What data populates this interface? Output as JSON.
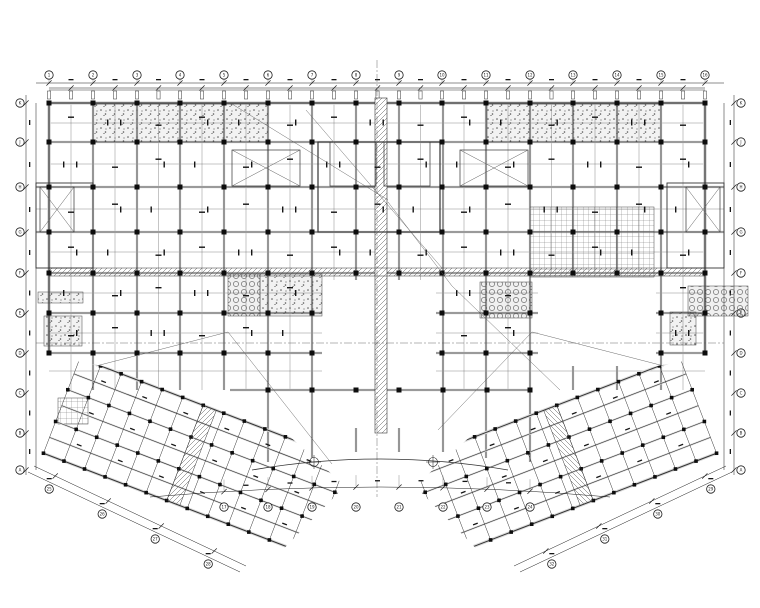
{
  "page": {
    "width": 760,
    "height": 608,
    "background": "#ffffff"
  },
  "colors": {
    "ink": "#1b1b1b",
    "beam_core": "#333333",
    "beam_halo": "#d8d8d8",
    "minor": "#5a5a5a",
    "column": "#0d0d0d",
    "hatch": "#555555",
    "speck": "#151515",
    "white": "#ffffff"
  },
  "plan": {
    "axes": {
      "top": {
        "bubble_y": 75,
        "xs": [
          49,
          93,
          137,
          180,
          224,
          268,
          312,
          356,
          399,
          442,
          486,
          530,
          573,
          617,
          661,
          705
        ],
        "labels": [
          "1",
          "2",
          "3",
          "4",
          "5",
          "6",
          "7",
          "8",
          "9",
          "10",
          "11",
          "12",
          "13",
          "14",
          "15",
          "16"
        ],
        "chain_ys": [
          83,
          88
        ]
      },
      "left": {
        "bubble_x": 20,
        "ys": [
          103,
          142,
          187,
          232,
          273,
          313,
          353,
          393,
          433,
          470
        ],
        "labels": [
          "K",
          "J",
          "H",
          "G",
          "F",
          "E",
          "D",
          "C",
          "B",
          "A"
        ],
        "chain_xs": [
          26,
          36
        ]
      },
      "right": {
        "bubble_x": 741,
        "ys": [
          103,
          142,
          187,
          232,
          273,
          313,
          353,
          393,
          433,
          470
        ],
        "labels": [
          "K",
          "J",
          "H",
          "G",
          "F",
          "E",
          "D",
          "C",
          "B",
          "A"
        ],
        "chain_xs": [
          734,
          724
        ]
      },
      "bottom_arc": {
        "bubble_y": 507,
        "xs": [
          224,
          268,
          312,
          356,
          399,
          443,
          487,
          530
        ],
        "labels": [
          "17",
          "18",
          "19",
          "20",
          "21",
          "22",
          "23",
          "24"
        ]
      },
      "wing_left": {
        "line_a": [
          34,
          466,
          246,
          566
        ],
        "line_b": [
          28,
          472,
          240,
          572
        ],
        "ts": [
          0.1,
          0.35,
          0.6,
          0.85
        ],
        "labels": [
          "25",
          "26",
          "27",
          "28"
        ]
      },
      "wing_right": {
        "ts": [
          0.1,
          0.35,
          0.6,
          0.85
        ],
        "labels": [
          "29",
          "30",
          "31",
          "32"
        ]
      }
    },
    "grid": {
      "main_xs": [
        49,
        93,
        137,
        180,
        224,
        268,
        312,
        356,
        399,
        442,
        486,
        530,
        573,
        617,
        661,
        705
      ],
      "row_segments": [
        {
          "y": 103,
          "w": 1.2,
          "seg": [
            [
              49,
              705
            ]
          ]
        },
        {
          "y": 142,
          "w": 0.8,
          "seg": [
            [
              49,
              705
            ]
          ]
        },
        {
          "y": 187,
          "w": 0.8,
          "seg": [
            [
              36,
              724
            ]
          ]
        },
        {
          "y": 232,
          "w": 0.8,
          "seg": [
            [
              36,
              724
            ]
          ]
        },
        {
          "y": 273,
          "w": 0.8,
          "seg": [
            [
              49,
              705
            ]
          ]
        },
        {
          "y": 313,
          "w": 0.8,
          "seg": [
            [
              49,
              322
            ],
            [
              436,
              538
            ],
            [
              656,
              705
            ]
          ]
        },
        {
          "y": 353,
          "w": 0.8,
          "seg": [
            [
              49,
              322
            ],
            [
              436,
              538
            ],
            [
              656,
              705
            ]
          ]
        },
        {
          "y": 390,
          "w": 0.8,
          "seg": [
            [
              230,
              530
            ]
          ]
        }
      ],
      "col_segments": {
        "49": [
          [
            103,
            353
          ]
        ],
        "93": [
          [
            103,
            390
          ]
        ],
        "137": [
          [
            103,
            390
          ]
        ],
        "180": [
          [
            103,
            390
          ]
        ],
        "224": [
          [
            103,
            390
          ]
        ],
        "268": [
          [
            103,
            462
          ]
        ],
        "312": [
          [
            103,
            458
          ]
        ],
        "356": [
          [
            103,
            280
          ],
          [
            428,
            452
          ]
        ],
        "399": [
          [
            103,
            280
          ],
          [
            428,
            452
          ]
        ],
        "443": [
          [
            103,
            452
          ]
        ],
        "486": [
          [
            103,
            458
          ]
        ],
        "530": [
          [
            103,
            462
          ]
        ],
        "573": [
          [
            103,
            273
          ],
          [
            366,
            390
          ]
        ],
        "617": [
          [
            103,
            273
          ],
          [
            366,
            390
          ]
        ],
        "661": [
          [
            103,
            390
          ]
        ],
        "705": [
          [
            103,
            353
          ]
        ]
      },
      "minor_rows": [
        {
          "y": 123,
          "seg": [
            [
              49,
              705
            ]
          ]
        },
        {
          "y": 164,
          "seg": [
            [
              49,
              705
            ]
          ]
        },
        {
          "y": 209,
          "seg": [
            [
              36,
              724
            ]
          ]
        },
        {
          "y": 252,
          "seg": [
            [
              49,
              705
            ]
          ]
        },
        {
          "y": 293,
          "seg": [
            [
              49,
              322
            ],
            [
              436,
              538
            ],
            [
              656,
              705
            ]
          ]
        },
        {
          "y": 333,
          "seg": [
            [
              49,
              322
            ],
            [
              436,
              538
            ],
            [
              656,
              705
            ]
          ]
        },
        {
          "y": 371,
          "seg": [
            [
              49,
              322
            ],
            [
              436,
              705
            ]
          ]
        }
      ],
      "void_a": [
        322,
        280,
        114,
        148
      ],
      "void_b": [
        538,
        273,
        118,
        93
      ],
      "column_ys": [
        103,
        142,
        187,
        232,
        273,
        313,
        353
      ],
      "arc_row": {
        "y": 390,
        "xs": [
          268,
          312,
          356,
          399,
          443,
          487,
          530
        ]
      }
    },
    "colonnade": {
      "top_y": 90,
      "box_y": 91,
      "box_h": 8
    },
    "strips": {
      "vertical": [
        375,
        98,
        12,
        335
      ],
      "horizontal": [
        49,
        268,
        656,
        8
      ]
    },
    "hatches": [
      {
        "x": 93,
        "y": 104,
        "w": 175,
        "h": 38,
        "type": "stipple"
      },
      {
        "x": 487,
        "y": 104,
        "w": 174,
        "h": 38,
        "type": "stipple"
      },
      {
        "x": 530,
        "y": 207,
        "w": 124,
        "h": 70,
        "type": "cross"
      },
      {
        "x": 228,
        "y": 274,
        "w": 32,
        "h": 42,
        "type": "circles"
      },
      {
        "x": 260,
        "y": 274,
        "w": 62,
        "h": 42,
        "type": "stipple"
      },
      {
        "x": 480,
        "y": 282,
        "w": 52,
        "h": 36,
        "type": "circles"
      },
      {
        "x": 688,
        "y": 286,
        "w": 60,
        "h": 30,
        "type": "circles"
      },
      {
        "x": 670,
        "y": 312,
        "w": 26,
        "h": 33,
        "type": "stipple"
      },
      {
        "x": 44,
        "y": 316,
        "w": 38,
        "h": 30,
        "type": "stipple"
      },
      {
        "x": 38,
        "y": 292,
        "w": 45,
        "h": 11,
        "type": "stipple"
      },
      {
        "x": 58,
        "y": 398,
        "w": 30,
        "h": 26,
        "type": "cross"
      }
    ],
    "stairs": [
      [
        232,
        150,
        68,
        36
      ],
      [
        460,
        150,
        68,
        36
      ]
    ],
    "braces": [
      [
        40,
        187,
        34,
        45
      ],
      [
        686,
        187,
        34,
        45
      ]
    ],
    "protrusions": [
      [
        36,
        183,
        57,
        85
      ],
      [
        667,
        183,
        57,
        85
      ]
    ],
    "core": [
      318,
      142,
      122,
      90
    ],
    "core_rooms": [
      [
        330,
        142,
        46,
        44
      ],
      [
        384,
        142,
        46,
        44
      ]
    ],
    "diagonals": [
      [
        232,
        104,
        388,
        200
      ],
      [
        306,
        110,
        442,
        268
      ],
      [
        388,
        202,
        452,
        286
      ],
      [
        452,
        286,
        560,
        390
      ],
      [
        228,
        332,
        332,
        464
      ],
      [
        532,
        332,
        438,
        430
      ],
      [
        96,
        366,
        228,
        332
      ],
      [
        664,
        366,
        532,
        332
      ]
    ],
    "center_lines": {
      "horizontal": [
        36,
        343,
        724,
        343
      ],
      "vertical": [
        377,
        60,
        377,
        497
      ]
    },
    "arcs": {
      "inner": "M252,470 Q380,448 508,470",
      "outer": "M150,497 Q380,477 610,497",
      "inner_pts": [
        252,
        470,
        380,
        448,
        508,
        470
      ],
      "outer_pts": [
        150,
        497,
        380,
        477,
        610,
        497
      ]
    },
    "survey_points": [
      [
        314,
        462
      ],
      [
        433,
        462
      ]
    ],
    "wings": {
      "mirror_width": 760,
      "left": {
        "origin": [
          80,
          358
        ],
        "angle": 21,
        "length": 300,
        "band_lines": 7,
        "band_gap": 17,
        "cross_count": 14,
        "cross_gap": 22,
        "strip_u": [
          132,
          146
        ],
        "clip": [
          [
            28,
            352
          ],
          [
            240,
            392
          ],
          [
            345,
            486
          ],
          [
            258,
            575
          ],
          [
            60,
            560
          ],
          [
            24,
            460
          ]
        ]
      }
    }
  }
}
